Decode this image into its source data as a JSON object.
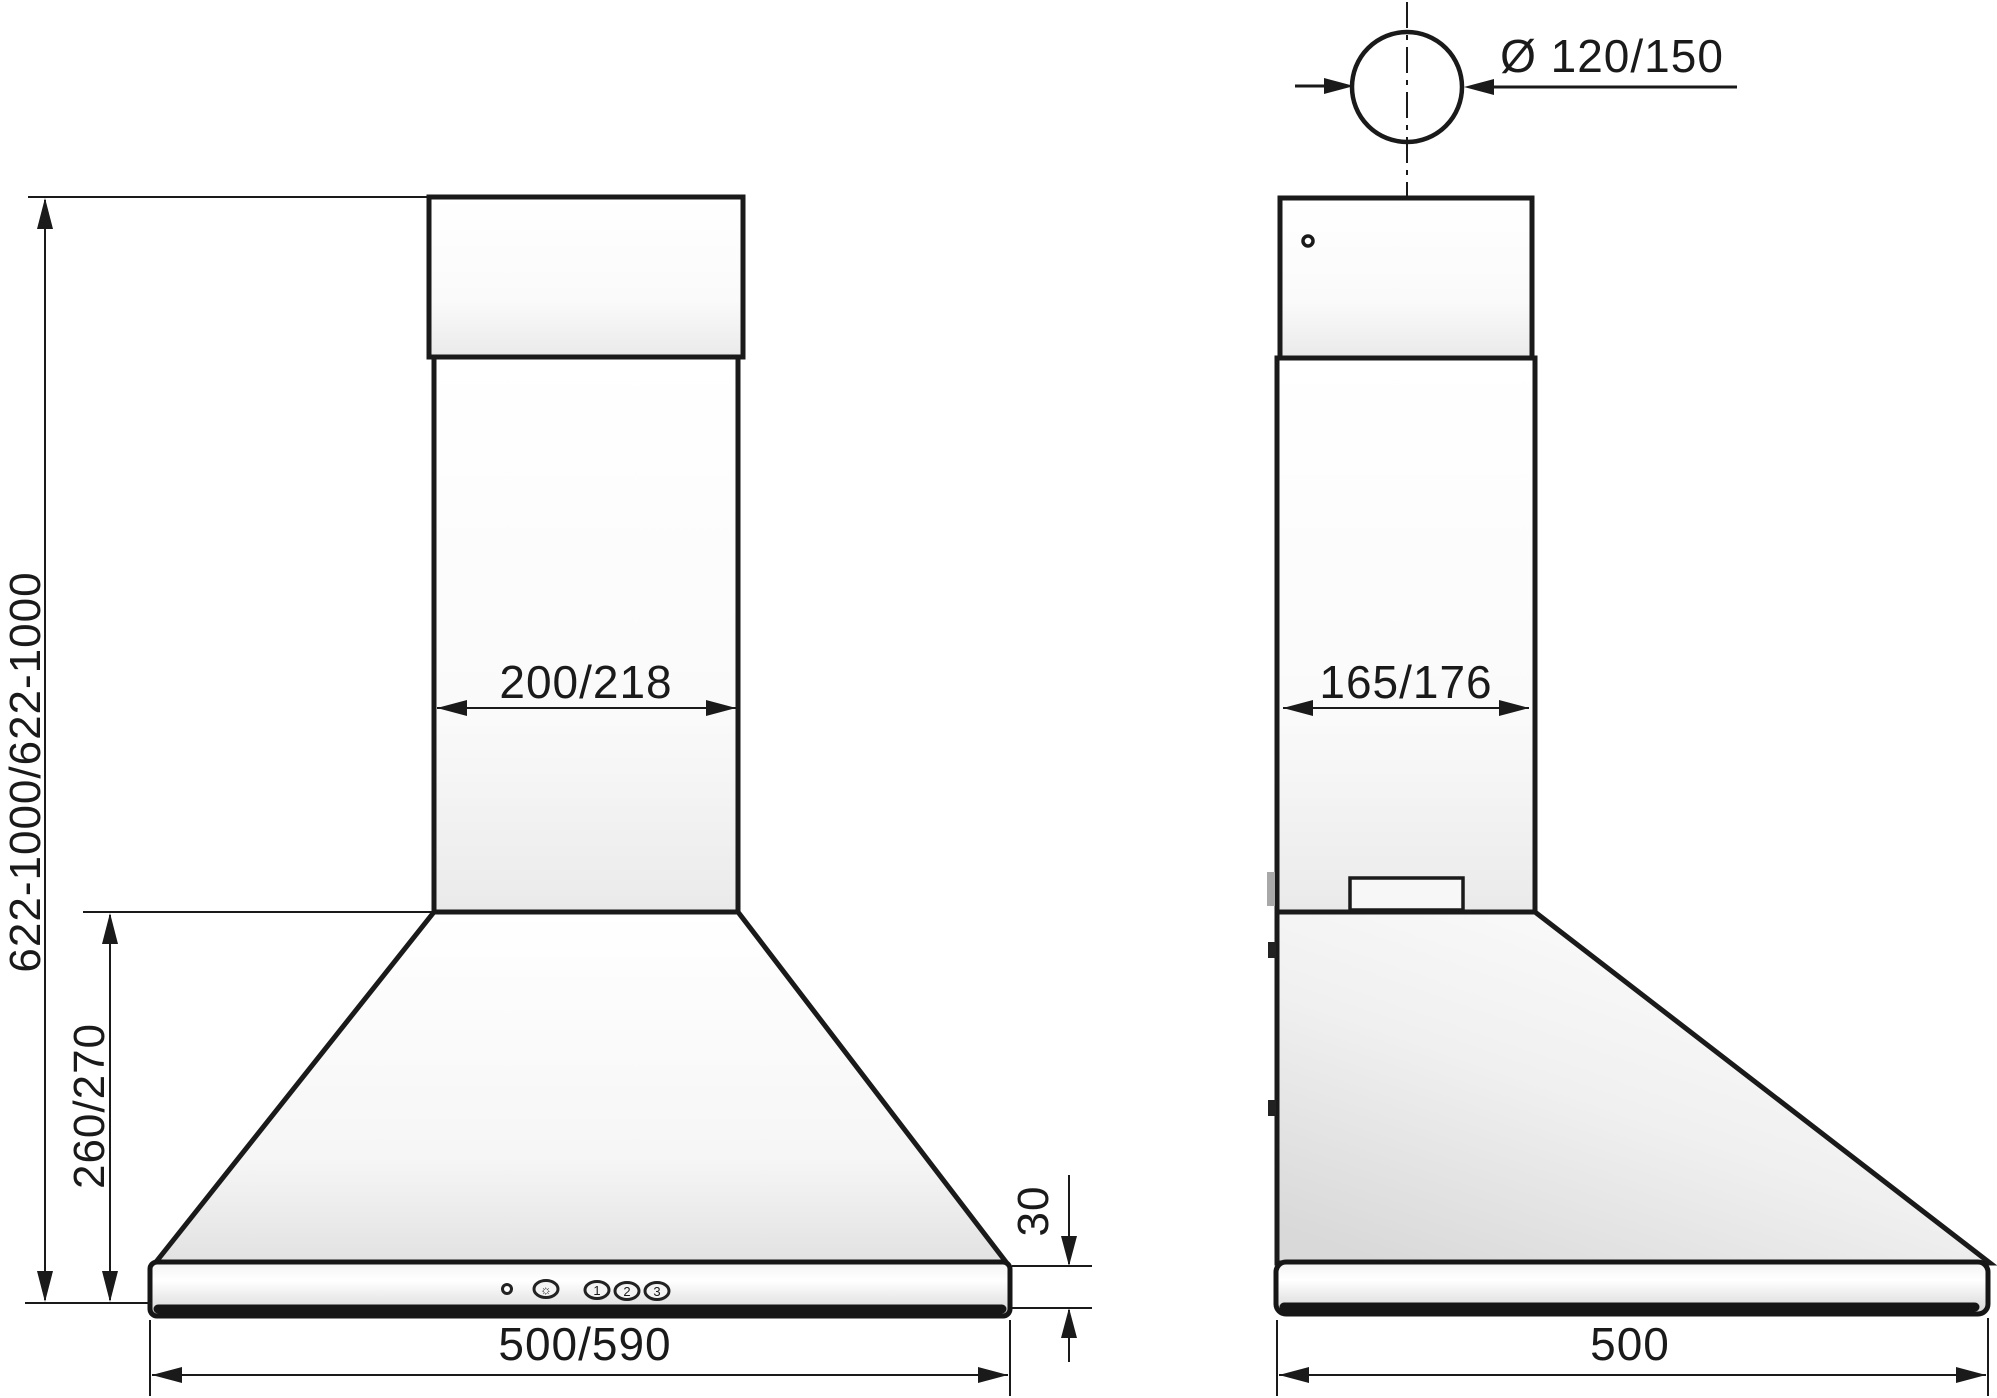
{
  "drawing": {
    "type": "technical-dimension-drawing",
    "subject": "wall-mounted chimney cooker hood, front and side elevation views"
  },
  "dimensions": {
    "duct_diameter": "Ø 120/150",
    "chimney_width": "200/218",
    "chimney_depth": "165/176",
    "overall_height": "622-1000/622-1000",
    "canopy_height": "260/270",
    "base_height": "30",
    "body_width": "500/590",
    "body_depth": "500"
  },
  "controls": {
    "light_button": "☼",
    "speed_buttons": [
      "1",
      "2",
      "3"
    ]
  },
  "colors": {
    "line": "#1a1a1a",
    "background": "#ffffff"
  }
}
